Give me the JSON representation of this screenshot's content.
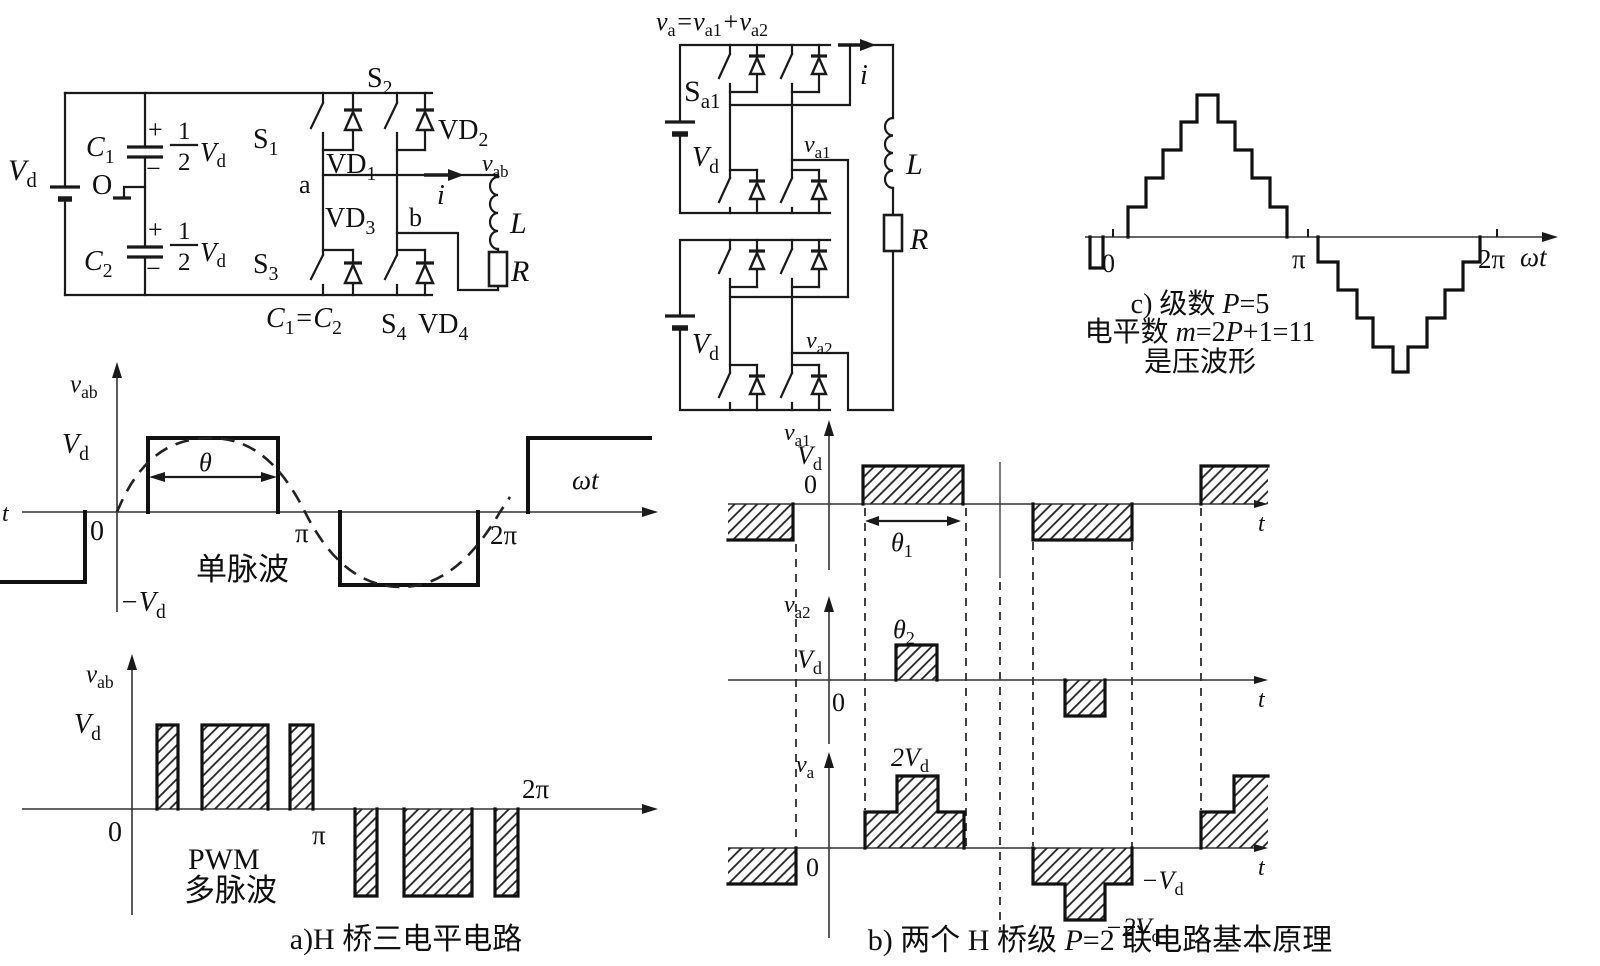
{
  "circuitA": {
    "vd": [
      "V",
      "d"
    ],
    "c1": [
      "C",
      "1"
    ],
    "o": "O",
    "c2": [
      "C",
      "2"
    ],
    "plus": "+",
    "minus": "−",
    "frac_num": "1",
    "frac_den": "2",
    "half_vd": [
      "V",
      "d"
    ],
    "s1": [
      "S",
      "1"
    ],
    "s2": [
      "S",
      "2"
    ],
    "s3": [
      "S",
      "3"
    ],
    "s4": [
      "S",
      "4"
    ],
    "vd1": [
      "VD",
      "1"
    ],
    "vd2": [
      "VD",
      "2"
    ],
    "vd3": [
      "VD",
      "3"
    ],
    "vd4": [
      "VD",
      "4"
    ],
    "a": "a",
    "b": "b",
    "vab": [
      "v",
      "ab"
    ],
    "i": "i",
    "l": "L",
    "r": "R",
    "c1c2": [
      "C",
      "1",
      "=C",
      "2"
    ]
  },
  "waveSingle": {
    "t": "t",
    "vab": [
      "v",
      "ab"
    ],
    "vd": [
      "V",
      "d"
    ],
    "zero": "0",
    "theta": "θ",
    "pi": "π",
    "name": "单脉波",
    "twopi": "2π",
    "omegat": "ωt",
    "negvd": [
      "−V",
      "d"
    ]
  },
  "wavePwm": {
    "vab": [
      "v",
      "ab"
    ],
    "vd": [
      "V",
      "d"
    ],
    "zero": "0",
    "pi": "π",
    "line1": "PWM",
    "line2": "多脉波",
    "twopi": "2π"
  },
  "captionA": "a)H 桥三电平电路",
  "circuitB": {
    "title": [
      "v",
      "a",
      "=",
      "v",
      "a1",
      "+",
      "v",
      "a2"
    ],
    "sa1": [
      "S",
      "a1"
    ],
    "vd": [
      "V",
      "d"
    ],
    "va1": [
      "v",
      "a1"
    ],
    "va2": [
      "v",
      "a2"
    ],
    "i": "i",
    "l": "L",
    "r": "R"
  },
  "waveB1": {
    "ax": [
      "v",
      "a1"
    ],
    "vd": [
      "V",
      "d"
    ],
    "zero": "0",
    "theta": [
      "θ",
      "1"
    ],
    "t": "t"
  },
  "waveB2": {
    "ax": [
      "v",
      "a2"
    ],
    "vd": [
      "V",
      "d"
    ],
    "zero": "0",
    "theta": [
      "θ",
      "2"
    ],
    "t": "t"
  },
  "waveB3": {
    "ax": [
      "v",
      "a"
    ],
    "zero": "0",
    "twovd": [
      "2V",
      "d"
    ],
    "negvd": [
      "−V",
      "d"
    ],
    "neg2vd": [
      "−2V",
      "d"
    ],
    "t": "t"
  },
  "captionB": [
    "b) 两个 H 桥级 ",
    "P",
    "=2 联电路基本原理"
  ],
  "waveC": {
    "zero": "0",
    "pi": "π",
    "twopi": "2π",
    "omegat": "ωt"
  },
  "captionC": {
    "l1": [
      "c) 级数 ",
      "P",
      "=5"
    ],
    "l2": [
      "电平数 ",
      "m",
      "=2",
      "P",
      "+1=11"
    ],
    "l3": "是压波形"
  }
}
